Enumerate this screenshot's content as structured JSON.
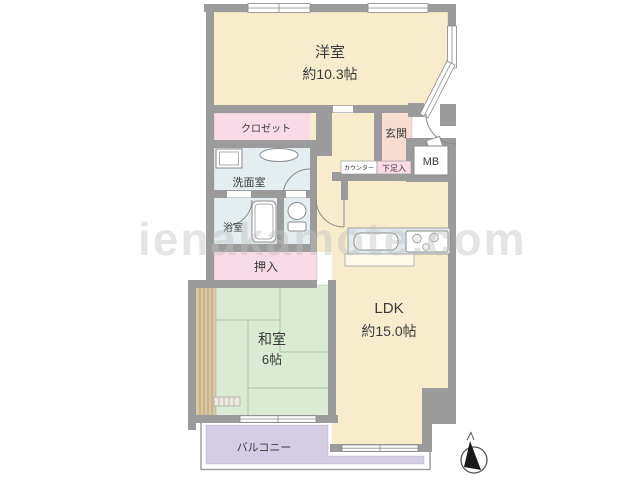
{
  "plan": {
    "watermark": "ienakamote.com",
    "rooms": {
      "yoshitsu": {
        "name": "洋室",
        "size": "約10.3帖"
      },
      "closet": {
        "name": "クロゼット"
      },
      "washroom": {
        "name": "洗面室"
      },
      "bathroom": {
        "name": "浴室"
      },
      "oshiire": {
        "name": "押入"
      },
      "washitsu": {
        "name": "和室",
        "size": "6帖"
      },
      "ldk": {
        "name": "LDK",
        "size": "約15.0帖"
      },
      "genkan": {
        "name": "玄関"
      },
      "shoe_box": {
        "name": "下足入"
      },
      "counter": {
        "name": "カウンター"
      },
      "meter_box": {
        "name": "MB"
      },
      "balcony": {
        "name": "バルコニー"
      }
    },
    "colors": {
      "wall": "#9b9b9b",
      "western_room": "#f7edcd",
      "ldk": "#f7edcd",
      "closet_pink": "#f9dbe8",
      "wet_area_blue": "#e4eef1",
      "tatami_green": "#dbead3",
      "genkan_salmon": "#f7dcd2",
      "balcony_lavender": "#d5cde4",
      "veranda_tan": "#d8c7a0",
      "kitchen_counter": "#dfe9ee",
      "label_text": "#3a3a3a",
      "watermark_gray": "#bfbfbf"
    }
  }
}
